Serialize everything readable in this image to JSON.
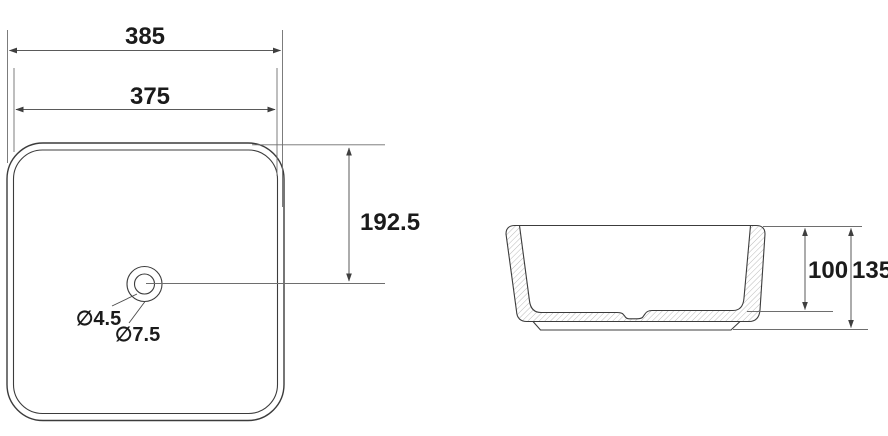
{
  "drawing": {
    "type": "basin-technical-dimension-drawing",
    "views": {
      "top": {
        "dimensions": {
          "overall_width": "385",
          "inner_width": "375",
          "drain_center_offset": "192.5",
          "drain_hole_diameter": "∅4.5",
          "drain_recess_diameter": "∅7.5"
        }
      },
      "side": {
        "dimensions": {
          "bowl_depth": "100",
          "overall_height": "135"
        }
      }
    },
    "colors": {
      "background": "#ffffff",
      "outline": "#3c3c3c",
      "dimension_lines": "#5a5a5a",
      "hatch": "#a8a8a8",
      "text": "#1b1b1b"
    }
  }
}
